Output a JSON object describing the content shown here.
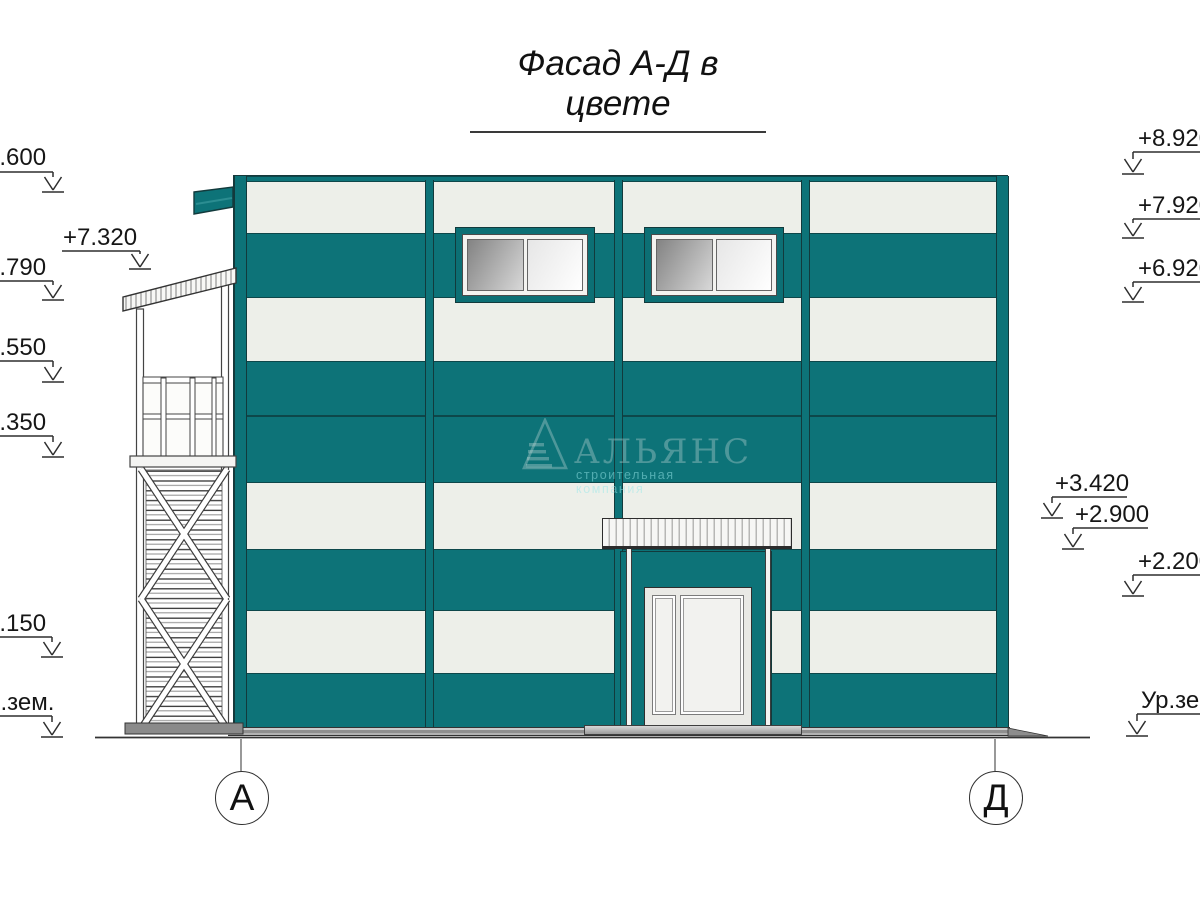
{
  "title": "Фасад А-Д в цвете",
  "watermark": {
    "logo": "alliance-pyramid-logo",
    "name": "АЛЬЯНС",
    "tagline": "строительная компания"
  },
  "elevation_marks_left": [
    "+8.600",
    "+7.320",
    "+6.790",
    "+5.550",
    "+4.350",
    "+1.150",
    "Ур.зем."
  ],
  "elevation_marks_right": [
    "+8.920",
    "+7.920",
    "+6.920",
    "+3.420",
    "+2.900",
    "+2.200",
    "Ур.зем."
  ],
  "axis_labels": {
    "left": "А",
    "right": "Д"
  },
  "colors": {
    "facade_teal": "#0d7378",
    "panel_white": "#edefe9",
    "outline_dark": "#16393b",
    "glass_dark": "#8a8a8a",
    "glass_light": "#f5f5f5",
    "ground_gray": "#9b9b9b"
  }
}
